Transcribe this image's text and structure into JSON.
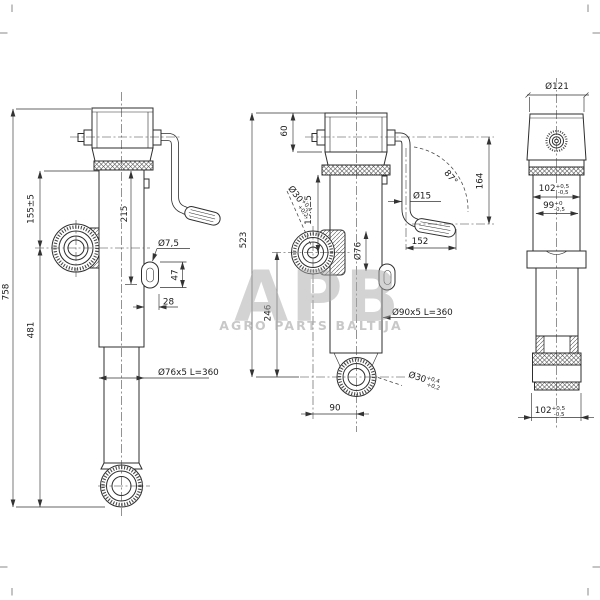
{
  "watermark": {
    "logo": "APB",
    "subtitle": "AGRO PARTS BALTIJA"
  },
  "left_view": {
    "overall_height": "758",
    "lower_height": "481",
    "clamp_offset": "155±5",
    "stroke_length": "215",
    "hole_dia": "Ø7,5",
    "slot_length": "47",
    "slot_offset": "28",
    "tube_spec": "Ø76x5 L=360"
  },
  "middle_view": {
    "cap_height": "60",
    "body_height": "523",
    "clamp_to_eye": "246",
    "clamp_offset": "155±5",
    "tube_dia": "Ø76",
    "crank_rod_dia": "Ø15",
    "crank_swing_angle": "87°",
    "crank_reach": "164",
    "handle_offset": "152",
    "outer_tube_spec": "Ø90x5 L=360",
    "eye_offset": "90",
    "clamp_bore": {
      "val": "Ø30",
      "sup": "+0,4",
      "sub": "+0,2"
    },
    "eye_bore": {
      "val": "Ø30",
      "sup": "+0,4",
      "sub": "+0,2"
    }
  },
  "right_view": {
    "cap_dia": "Ø121",
    "upper_width": {
      "val": "102",
      "sup": "+0,5",
      "sub": "-0,5"
    },
    "inner_width": {
      "val": "99",
      "sup": "+0",
      "sub": "-0,5"
    },
    "foot_width": {
      "val": "102",
      "sup": "+0,5",
      "sub": "-0,5"
    }
  }
}
